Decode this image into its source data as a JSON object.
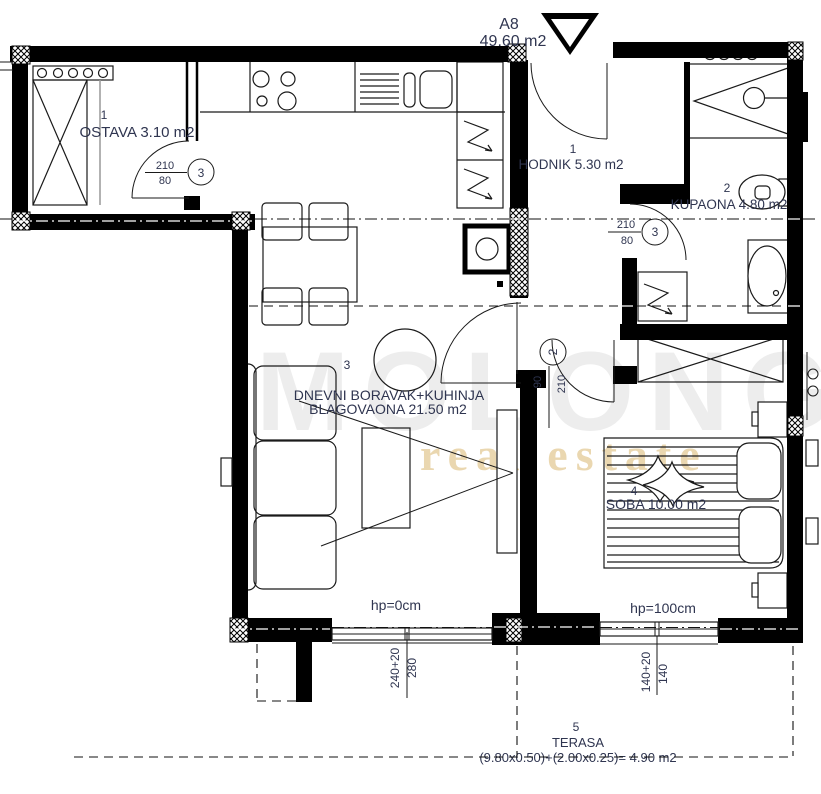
{
  "plan": {
    "unit_label": "A8",
    "unit_area": "49.60 m2",
    "rooms": {
      "ostava": {
        "num": "1",
        "name": "OSTAVA 3.10 m2"
      },
      "hodnik": {
        "num": "1",
        "name": "HODNIK 5.30 m2"
      },
      "kupaona": {
        "num": "2",
        "name": "KUPAONA 4.80 m2"
      },
      "dnevni": {
        "num": "3",
        "line1": "DNEVNI BORAVAK+KUHINJA",
        "line2": "BLAGOVAONA 21.50 m2"
      },
      "soba": {
        "num": "4",
        "name": "SOBA 10.00 m2"
      },
      "terasa": {
        "num": "5",
        "name": "TERASA",
        "formula": "(9.80x0.50)+(2.00x0.25)= 4.90 m2"
      }
    },
    "doors": {
      "ostava_door": {
        "height": "210",
        "width": "80",
        "mark": "3"
      },
      "kupaona_door": {
        "height": "210",
        "width": "80",
        "mark": "3"
      },
      "dnevni_door": {
        "height": "210",
        "width": "90",
        "mark": "2"
      }
    },
    "windows": {
      "living": {
        "parapet": "hp=0cm",
        "dim1": "240+20",
        "dim2": "280"
      },
      "bedroom": {
        "parapet": "hp=100cm",
        "dim1": "140+20",
        "dim2": "140"
      }
    },
    "watermark": {
      "brand": "MOLONGO",
      "tagline": "real estate"
    }
  },
  "colors": {
    "line": "#000000",
    "label_text": "#2f3550",
    "hodnik_number": "#b86b28",
    "dnevni_number": "#3f5fa0",
    "watermark_gray": "#ededed",
    "watermark_tan": "#ead7b0"
  }
}
